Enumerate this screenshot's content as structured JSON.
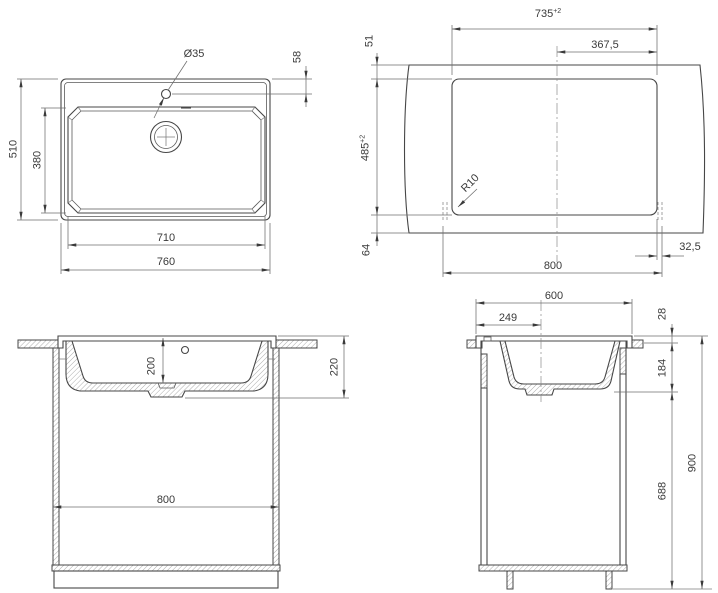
{
  "drawing": {
    "top_view": {
      "overall_width": "760",
      "basin_width": "710",
      "overall_depth": "510",
      "basin_depth": "380",
      "tap_hole_diameter": "Ø35",
      "tap_hole_offset": "58"
    },
    "cutout_view": {
      "cutout_width": "735",
      "cutout_width_tol": "+2",
      "center_offset": "367,5",
      "front_clearance": "51",
      "cutout_depth": "485",
      "cutout_depth_tol": "+2",
      "rear_clearance": "64",
      "cabinet_width": "800",
      "side_clearance": "32,5",
      "corner_radius": "R10"
    },
    "front_view": {
      "bowl_depth": "200",
      "total_depth": "220",
      "cabinet_width": "800"
    },
    "side_view": {
      "sink_width": "600",
      "drain_offset": "249",
      "rim_height": "28",
      "under_counter_depth": "184",
      "cabinet_height": "688",
      "total_height": "900"
    }
  }
}
